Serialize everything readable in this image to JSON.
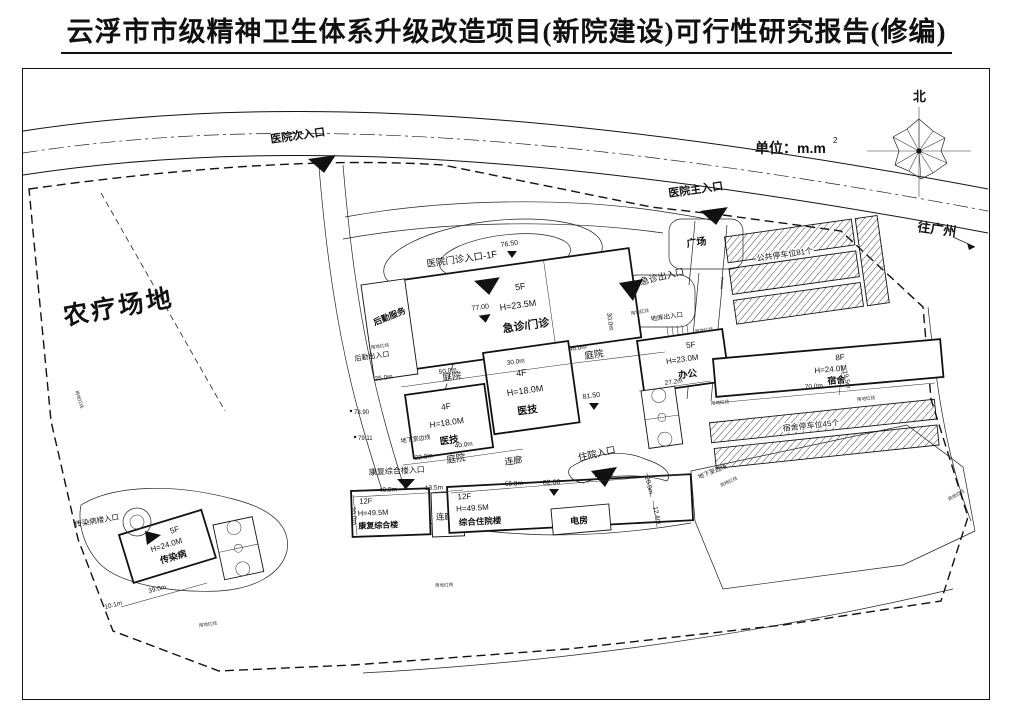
{
  "title": "云浮市市级精神卫生体系升级改造项目(新院建设)可行性研究报告(修编)",
  "legend": {
    "north": "北",
    "unit": "单位：m.m",
    "unit_exp": "2",
    "to_guangzhou": "往广州"
  },
  "areas": {
    "farm": "农疗场地",
    "plaza": "广场",
    "courtyard": "庭院",
    "corridor": "连廊",
    "power_room": "电房"
  },
  "buildings": {
    "emergency": {
      "floors": "5F",
      "height": "H=23.5M",
      "name": "急诊/门诊"
    },
    "logistics": {
      "name": "后勤服务"
    },
    "medtech": {
      "floors": "4F",
      "height": "H=18.0M",
      "name": "医技"
    },
    "office": {
      "floors": "5F",
      "height": "H=23.0M",
      "name": "办公"
    },
    "dorm": {
      "floors": "8F",
      "height": "H=24.0M",
      "name": "宿舍"
    },
    "rehab": {
      "floors": "12F",
      "height": "H=49.5M",
      "name": "康复综合楼"
    },
    "inpatient": {
      "floors": "12F",
      "height": "H=49.5M",
      "name": "综合住院楼"
    },
    "infectious": {
      "floors": "5F",
      "height": "H=24.0M",
      "name": "传染病"
    }
  },
  "entrances": {
    "secondary": "医院次入口",
    "main": "医院主入口",
    "outpatient": "医院门诊入口-1F",
    "emergency_io": "急诊出入口",
    "basement_io": "地库出入口",
    "underground_edge": "地下室边线",
    "logistics_io": "后勤出入口",
    "inpatient_in": "住院入口",
    "rehab_in": "康复综合楼入口",
    "infectious_in": "传染病楼入口"
  },
  "parking": {
    "public": "公共停车位81个",
    "dorm": "宿舍停车位45个"
  },
  "elevations": {
    "e7650": "76.50",
    "e7700": "77.00",
    "e8150": "81.50",
    "e8200": "82.00",
    "e7890": "78.90",
    "e7911": "79.11"
  },
  "dimensions": {
    "d50_0": "50.0m",
    "d30_0": "30.0m",
    "d46_0": "46.0m",
    "d25_0": "25.0m",
    "d40_0": "40.0m",
    "d22_0": "22.0m",
    "d13_5": "13.5m",
    "d65_8": "65.8m",
    "d48_5": "48.5m",
    "d70_0": "70.0m",
    "d27_2": "27.2m",
    "d19_5": "19.5m",
    "d20_0": "20.0m",
    "d12_4": "12.4m",
    "d39_0": "39.0m",
    "d10_1": "10.1m"
  },
  "boundary_note": "用地红线"
}
